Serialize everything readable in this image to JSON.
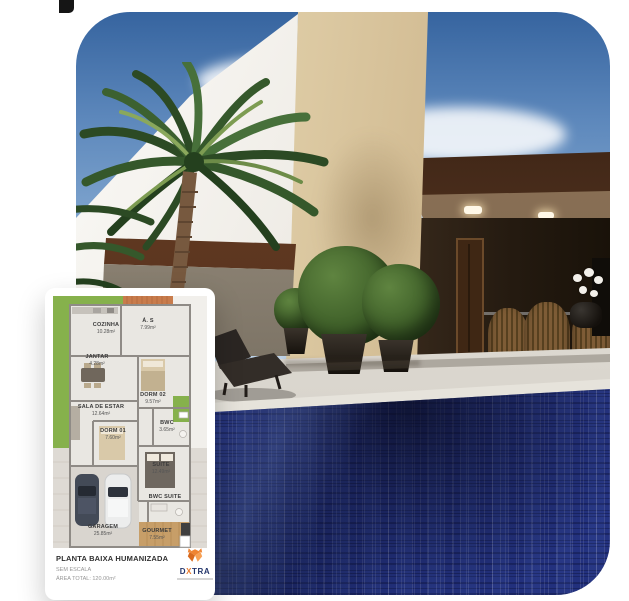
{
  "floorplan": {
    "rooms": [
      {
        "name": "COZINHA",
        "area": "10.28m²"
      },
      {
        "name": "Á. S",
        "area": "7.99m²"
      },
      {
        "name": "JANTAR",
        "area": "4.28m²"
      },
      {
        "name": "DORM 02",
        "area": "9.57m²"
      },
      {
        "name": "SALA DE ESTAR",
        "area": "12.64m²"
      },
      {
        "name": "BWC",
        "area": "3.65m²"
      },
      {
        "name": "DORM 01",
        "area": "7.60m²"
      },
      {
        "name": "SUITE",
        "area": "12.49m²"
      },
      {
        "name": "BWC SUITE",
        "area": ""
      },
      {
        "name": "GARAGEM",
        "area": "25.85m²"
      },
      {
        "name": "GOURMET",
        "area": "7.55m²"
      }
    ],
    "footer": {
      "title": "PLANTA BAIXA HUMANIZADA",
      "scale": "SEM ESCALA",
      "total_area": "ÁREA TOTAL: 120.00m²",
      "logo": {
        "d": "D",
        "x": "X",
        "tra": "TRA"
      }
    }
  },
  "palette": {
    "pool_blue": "#2a3a8e",
    "fascia_brown": "#53331f",
    "tower_beige": "#dcc9a2",
    "lawn_green": "#86b14c",
    "service_deck_orange": "#c87c4c",
    "gourmet_wood": "#c79e68",
    "logo_orange": "#e87a2e",
    "logo_navy": "#23356b"
  }
}
